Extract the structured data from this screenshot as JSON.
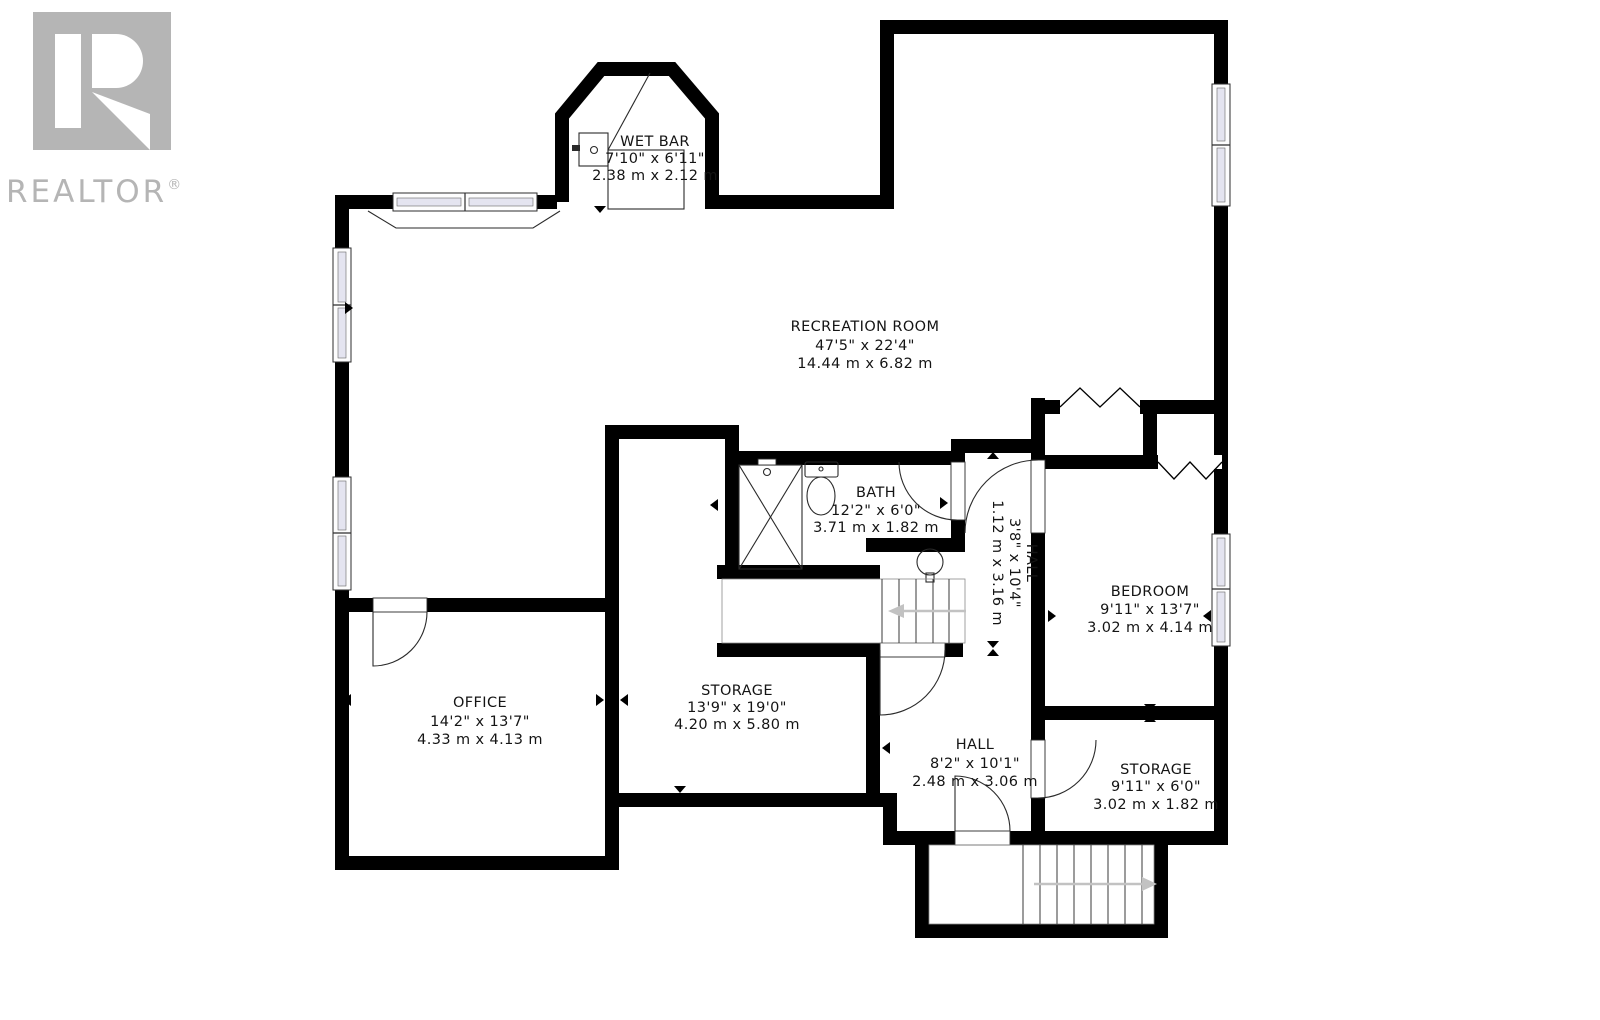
{
  "logo": {
    "brand": "REALTOR",
    "registered": "®",
    "color": "#b5b5b5"
  },
  "plan": {
    "wall_color": "#000000",
    "text_color": "#141414",
    "window_glass_color": "#e4e4f0",
    "stair_arrow_color": "#c2c2c2",
    "rooms": [
      {
        "id": "wet-bar",
        "name": "WET BAR",
        "imperial": "7'10\" x 6'11\"",
        "metric": "2.38 m x 2.12 m"
      },
      {
        "id": "recreation-room",
        "name": "RECREATION ROOM",
        "imperial": "47'5\" x 22'4\"",
        "metric": "14.44 m x 6.82 m"
      },
      {
        "id": "bath",
        "name": "BATH",
        "imperial": "12'2\" x 6'0\"",
        "metric": "3.71 m x 1.82 m"
      },
      {
        "id": "hall-upper",
        "name": "HALL",
        "imperial": "3'8\" x 10'4\"",
        "metric": "1.12 m x 3.16 m"
      },
      {
        "id": "bedroom",
        "name": "BEDROOM",
        "imperial": "9'11\" x 13'7\"",
        "metric": "3.02 m x 4.14 m"
      },
      {
        "id": "office",
        "name": "OFFICE",
        "imperial": "14'2\" x 13'7\"",
        "metric": "4.33 m x 4.13 m"
      },
      {
        "id": "storage-large",
        "name": "STORAGE",
        "imperial": "13'9\" x 19'0\"",
        "metric": "4.20 m x 5.80 m"
      },
      {
        "id": "hall-lower",
        "name": "HALL",
        "imperial": "8'2\" x 10'1\"",
        "metric": "2.48 m x 3.06 m"
      },
      {
        "id": "storage-small",
        "name": "STORAGE",
        "imperial": "9'11\" x 6'0\"",
        "metric": "3.02 m x 1.82 m"
      }
    ]
  }
}
